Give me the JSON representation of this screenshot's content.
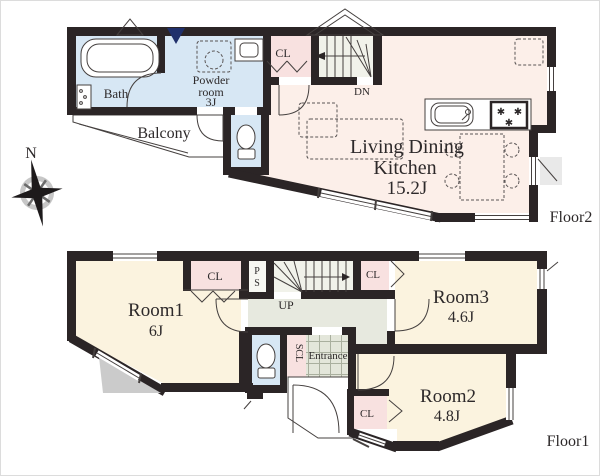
{
  "compass": {
    "north_label": "N"
  },
  "floor2": {
    "floor_label": "Floor2",
    "bath_label": "Bath",
    "powder_lines": [
      "Powder",
      "room",
      "3J"
    ],
    "closet_label": "CL",
    "balcony_label": "Balcony",
    "stairs_label": "DN",
    "ldk_lines": [
      "Living Dining",
      "Kitchen",
      "15.2J"
    ]
  },
  "floor1": {
    "floor_label": "Floor1",
    "room1_label": "Room1",
    "room1_size": "6J",
    "room1_closet_label": "CL",
    "pipe_space_letters": [
      "P",
      "S"
    ],
    "stairs_label": "UP",
    "shoe_closet_label": "SCL",
    "entrance_label": "Entrance",
    "room3_label": "Room3",
    "room3_size": "4.6J",
    "room3_closet_label": "CL",
    "room2_label": "Room2",
    "room2_size": "4.8J",
    "room2_closet_label": "CL"
  },
  "icons": {
    "stove_burner": "✱"
  },
  "colors": {
    "wall": "#2b2526",
    "room_cream": "#fbf3df",
    "ldk_pink": "#fcefe9",
    "closet_pink": "#f8e1e0",
    "wet_area_blue": "#d7e7f4",
    "hall_gray": "#e7e9df",
    "entrance_tile": "#e3e6da",
    "marker_navy": "#20306b"
  }
}
